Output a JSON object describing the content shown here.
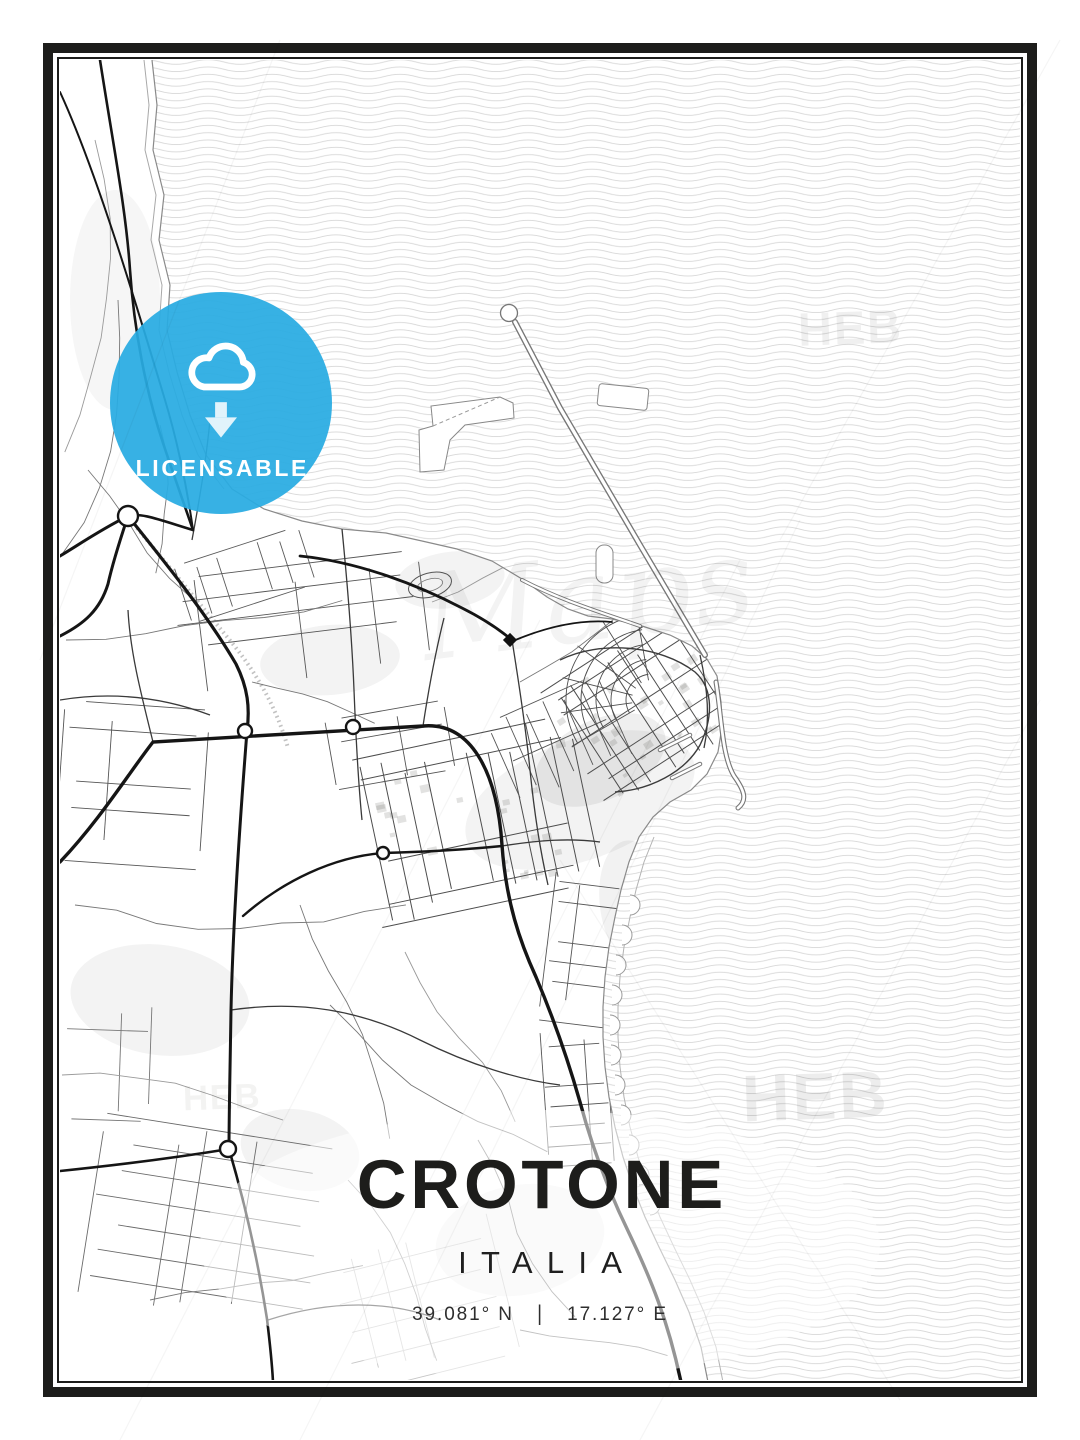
{
  "poster": {
    "title": "CROTONE",
    "subtitle": "ITALIA",
    "coordinates": {
      "lat": "39.081° N",
      "separator": "|",
      "lon": "17.127° E"
    },
    "frame_color": "#1d1d1b"
  },
  "badge": {
    "label": "LICENSABLE",
    "icon": "cloud-download",
    "background_color": "#29abe2",
    "text_color": "#ffffff"
  },
  "watermarks": [
    {
      "text": "HEB",
      "position": "sea-top-right"
    },
    {
      "text": "HEB",
      "position": "sea-bottom-right"
    },
    {
      "text": "HEB",
      "position": "land-bottom-left"
    },
    {
      "text": "Maps",
      "position": "map-center-script"
    }
  ],
  "map": {
    "subject": "street map of Crotone, Italy",
    "land_color": "#ffffff",
    "sea_style": "wavy-line-pattern",
    "sea_line_color": "#d6d6d6",
    "road_color": "#151515"
  }
}
